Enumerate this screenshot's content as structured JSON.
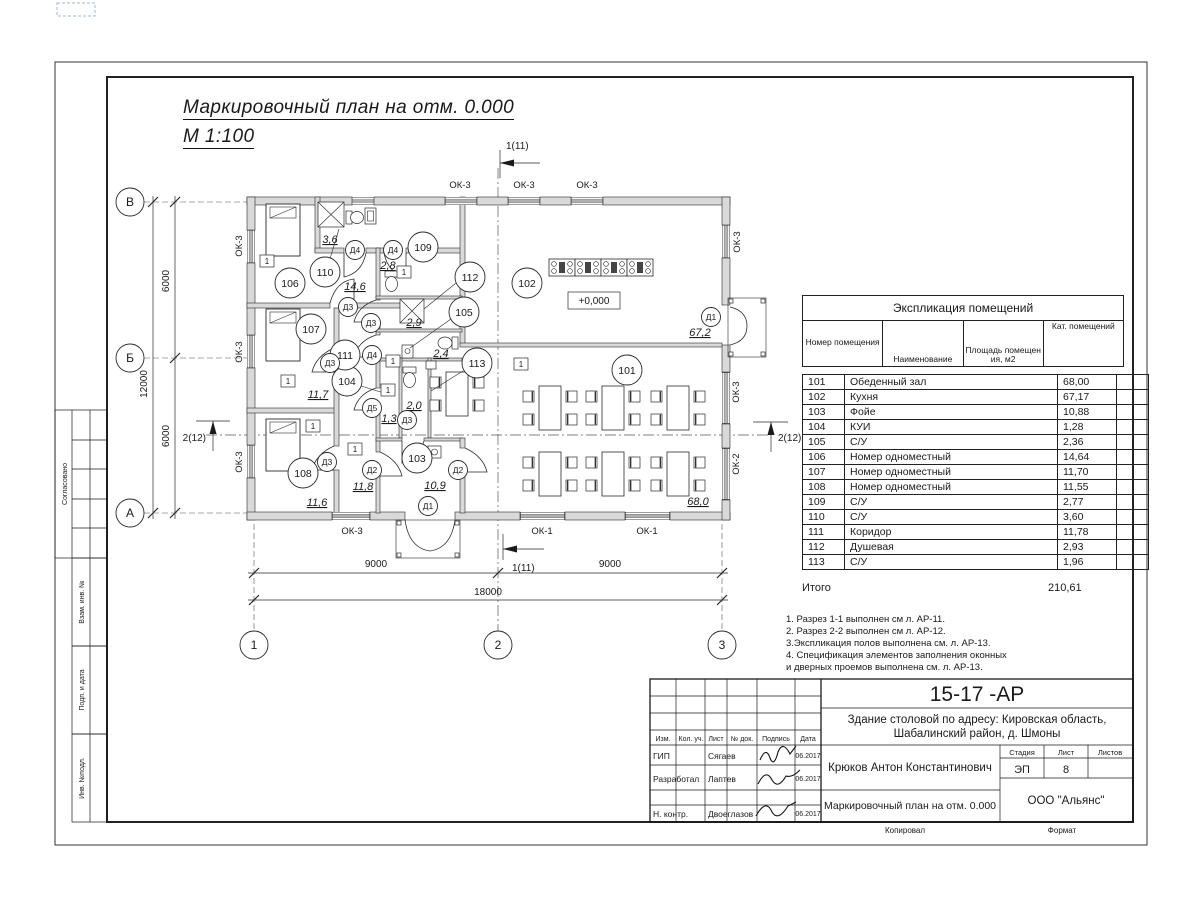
{
  "sheet": {
    "title_line1": "Маркировочный план  на отм. 0.000",
    "title_line2": "М 1:100",
    "copied_label": "Копировал",
    "format_label": "Формат",
    "side_labels": {
      "agreed": "Согласовано",
      "vzam": "Взам. инв. №",
      "podp": "Подп. и дата",
      "inv": "Инв. №подл."
    }
  },
  "plan": {
    "level_mark": "+0,000",
    "wall_mark": "1",
    "axes": {
      "rows": [
        "В",
        "Б",
        "А"
      ],
      "cols": [
        "1",
        "2",
        "3"
      ]
    },
    "dims": {
      "left_seg1": "6000",
      "left_seg2": "6000",
      "left_total": "12000",
      "bottom_seg1": "9000",
      "bottom_seg2": "9000",
      "bottom_total": "18000"
    },
    "sections": {
      "s1": "1(11)",
      "s2": "2(12)"
    },
    "windows": {
      "ok1": "ОК-1",
      "ok2": "ОК-2",
      "ok3": "ОК-3"
    },
    "doors": {
      "d1": "Д1",
      "d2": "Д2",
      "d3": "Д3",
      "d4": "Д4",
      "d5": "Д5"
    },
    "rooms": {
      "r101": {
        "num": "101",
        "area": "68,0"
      },
      "r102": {
        "num": "102",
        "area": "67,2"
      },
      "r103": {
        "num": "103",
        "area": "10,9"
      },
      "r104": {
        "num": "104",
        "area": "1,3"
      },
      "r105": {
        "num": "105",
        "area": "2,4"
      },
      "r106": {
        "num": "106",
        "area": "14,6"
      },
      "r107": {
        "num": "107",
        "area": "11,7"
      },
      "r108": {
        "num": "108",
        "area": "11,6"
      },
      "r109": {
        "num": "109",
        "area": "2,8"
      },
      "r110": {
        "num": "110",
        "area": "3,6"
      },
      "r111": {
        "num": "111",
        "area": "11,8"
      },
      "r112": {
        "num": "112",
        "area": "2,9"
      },
      "r113": {
        "num": "113",
        "area": "2,0"
      }
    }
  },
  "schedule": {
    "title": "Экспликация помещений",
    "headers": [
      "Номер помещения",
      "Наименование",
      "Площадь помещения, м2",
      "Кат. помещений"
    ],
    "rows": [
      [
        "101",
        "Обеденный зал",
        "68,00"
      ],
      [
        "102",
        "Кухня",
        "67,17"
      ],
      [
        "103",
        "Фойе",
        "10,88"
      ],
      [
        "104",
        "КУИ",
        "1,28"
      ],
      [
        "105",
        "С/У",
        "2,36"
      ],
      [
        "106",
        "Номер одноместный",
        "14,64"
      ],
      [
        "107",
        "Номер одноместный",
        "11,70"
      ],
      [
        "108",
        "Номер одноместный",
        "11,55"
      ],
      [
        "109",
        "С/У",
        "2,77"
      ],
      [
        "110",
        "С/У",
        "3,60"
      ],
      [
        "111",
        "Коридор",
        "11,78"
      ],
      [
        "112",
        "Душевая",
        "2,93"
      ],
      [
        "113",
        "С/У",
        "1,96"
      ]
    ],
    "total_label": "Итого",
    "total_value": "210,61"
  },
  "notes": [
    "1. Разрез 1-1 выполнен см л. АР-11.",
    "2. Разрез 2-2 выполнен см л. АР-12.",
    "3.Экспликация полов выполнена  см. л. АР-13.",
    "4. Спецификация элементов заполнения оконных",
    " и дверных проемов выполнена  см. л. АР-13."
  ],
  "titleblock": {
    "doc_code": "15-17 -АР",
    "project_line1": "Здание столовой по адресу: Кировская область,",
    "project_line2": "Шабалинский район, д. Шмоны",
    "author": "Крюков Антон Константинович",
    "drawing_title": "Маркировочный план  на отм. 0.000",
    "org": "ООО \"Альянс\"",
    "stage_label": "Стадия",
    "sheet_label": "Лист",
    "sheets_label": "Листов",
    "stage": "ЭП",
    "sheet_num": "8",
    "columns": [
      "Изм.",
      "Кол. уч.",
      "Лист",
      "№ док.",
      "Подпись",
      "Дата"
    ],
    "signature_rows": [
      {
        "role": "ГИП",
        "name": "Сягаев",
        "date": "06.2017"
      },
      {
        "role": "Разработал",
        "name": "Лаптев",
        "date": "06.2017"
      },
      {
        "role": "Н. контр.",
        "name": "Двоеглазов",
        "date": "06.2017"
      }
    ]
  }
}
